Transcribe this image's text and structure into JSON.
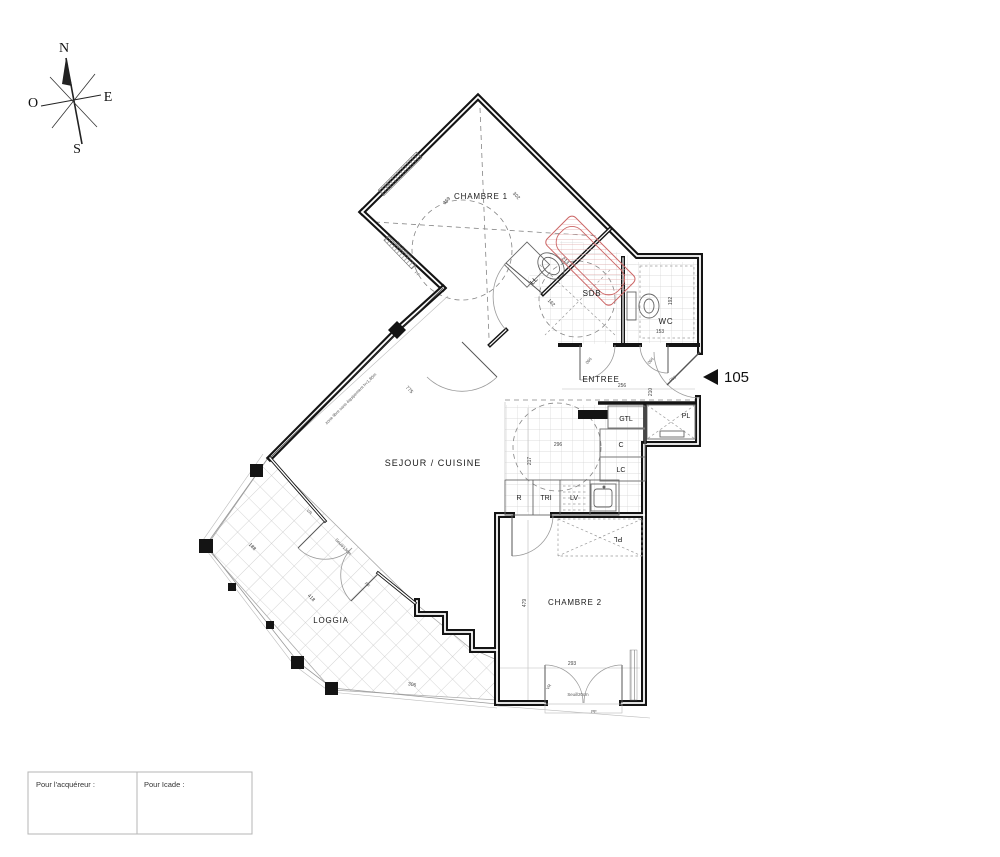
{
  "compass": {
    "north": "N",
    "east": "E",
    "west": "O",
    "south": "S"
  },
  "unit_marker": {
    "number": "105"
  },
  "rooms": {
    "chambre1": "CHAMBRE 1",
    "sdb": "SDB",
    "wc": "WC",
    "entree": "ENTREE",
    "sejour_cuisine": "SEJOUR / CUISINE",
    "loggia": "LOGGIA",
    "chambre2": "CHAMBRE 2"
  },
  "closets": {
    "gtl": "GTL",
    "pl_entree": "PL",
    "c": "C",
    "lc": "LC",
    "pl_chambre2": "PL"
  },
  "kitchen": {
    "r": "R",
    "tri": "TRI",
    "lv": "LV"
  },
  "laundry": {
    "ll": "LL"
  },
  "dims": {
    "chambre1_d1": "369",
    "chambre1_d2": "302",
    "corridor": "775",
    "entree_w": "256",
    "entree_h": "210",
    "wc_w": "153",
    "wc_h": "192",
    "sdb_d1": "213",
    "sdb_d2": "162",
    "kitchen_h": "217",
    "kitchen_circle": "296",
    "chambre2_h": "479",
    "chambre2_w": "293",
    "loggia_d1": "418",
    "loggia_d2": "188",
    "loggia_d3": "306"
  },
  "annotations": {
    "zone_libre": "zone libre sans équipement h<1,80m",
    "seuil_20": "Seuil/20cm",
    "seuil_13": "Seuil/13cm",
    "vr": "VR",
    "pf": "PF",
    "door_code": "066"
  },
  "signature": {
    "acquereur_label": "Pour l'acquéreur :",
    "icade_label": "Pour Icade :"
  },
  "colors": {
    "wall": "#141414",
    "line": "#888888",
    "dim_text": "#444444",
    "tub": "#cc7777",
    "tile": "#c8c8c8"
  }
}
